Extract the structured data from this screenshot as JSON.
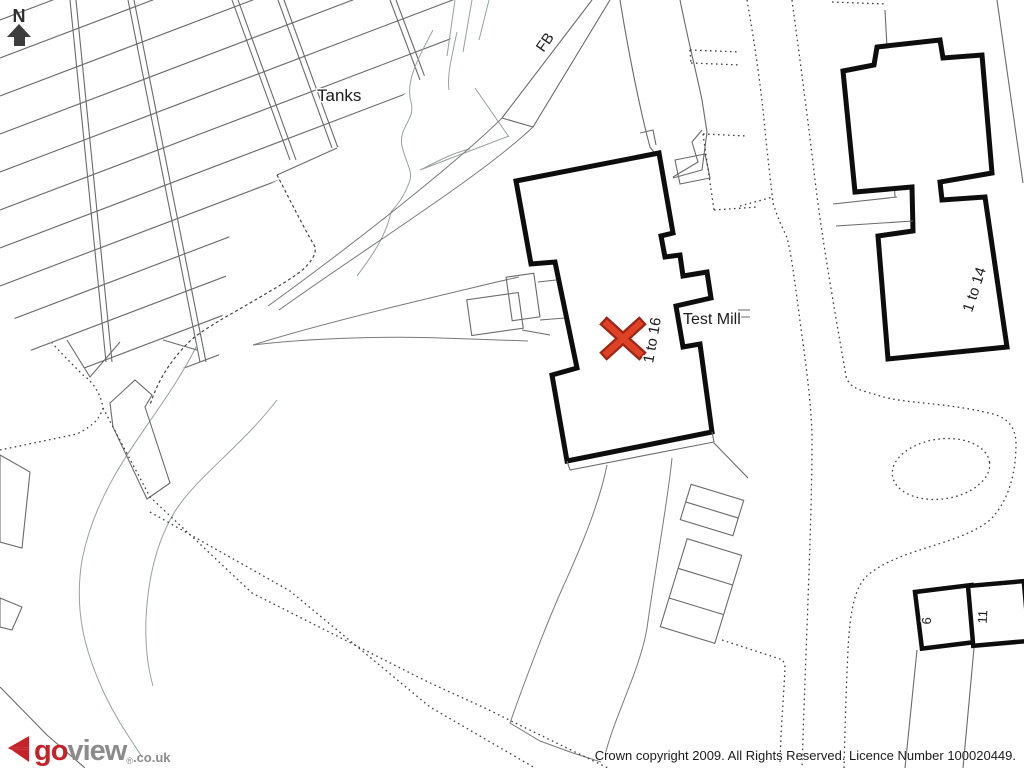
{
  "page": {
    "background": "#ffffff"
  },
  "compass": {
    "label": "N",
    "arrow_color": "#3d3d3d"
  },
  "map_labels": {
    "tanks": "Tanks",
    "footbridge": "FB",
    "test_mill": "Test Mill",
    "mill_units": "1 to 16",
    "east_units": "1 to 14",
    "house_6": "6",
    "house_11": "11"
  },
  "marker": {
    "shape": "x-cross",
    "color": "#de4226",
    "outline_color": "#9e2413"
  },
  "colors": {
    "building_outline": "#0d0d0d",
    "thin_line": "#6a6a6a",
    "contour_line": "#98a0a0",
    "dotted_line": "#3f3f3f"
  },
  "footer": {
    "logo": {
      "word_go": "go",
      "word_view": "view",
      "registered": "®",
      "domain_suffix": ".co.uk",
      "accent_red": "#c4232a",
      "text_gray": "#8b8b8b"
    },
    "copyright": "Crown copyright 2009. All Rights Reserved. Licence Number 100020449."
  }
}
